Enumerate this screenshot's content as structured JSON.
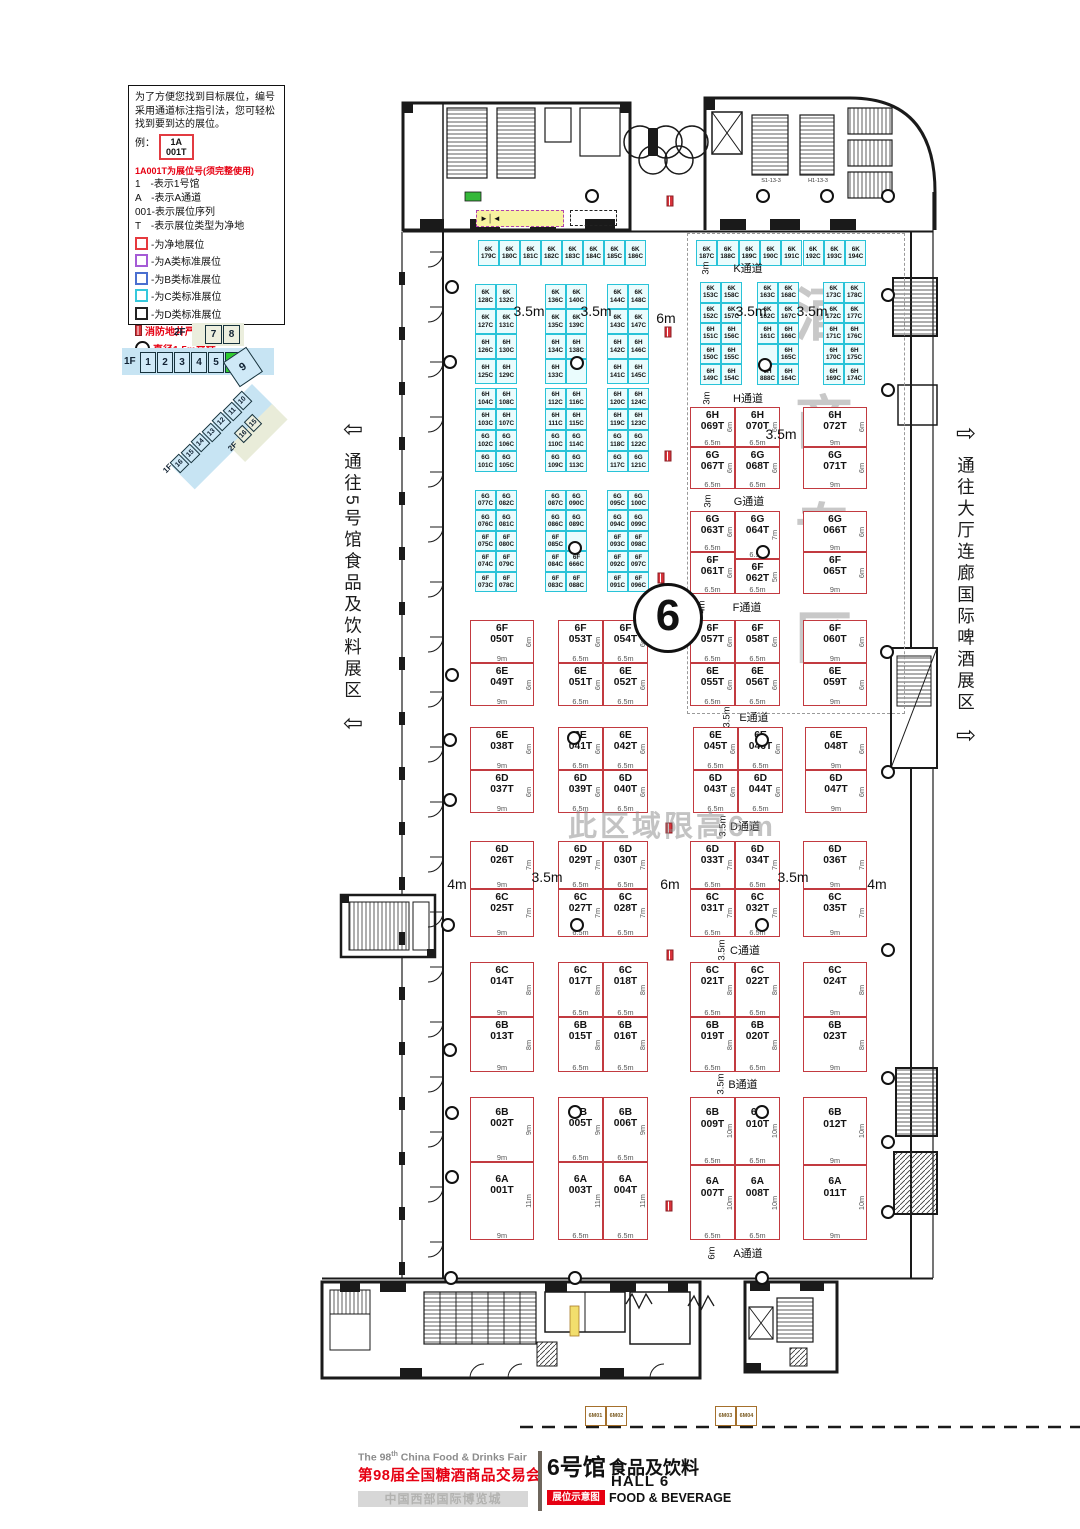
{
  "hall_circle": "6",
  "legend": {
    "intro": "为了方便您找到目标展位，编号采用通道标注指引法，您可轻松找到要到达的展位。",
    "example_label": "例：",
    "example_line1": "1A",
    "example_line2": "001T",
    "red_note": "1A001T为展位号(须完整使用)",
    "items": [
      "1　-表示1号馆",
      "A　-表示A通道",
      "001-表示展位序列",
      "T　-表示展位类型为净地"
    ],
    "swatches": [
      {
        "color": "#e6393e",
        "label": "-为净地展位"
      },
      {
        "color": "#a55bd6",
        "label": "-为A类标准展位"
      },
      {
        "color": "#4a6fd0",
        "label": "-为B类标准展位"
      },
      {
        "color": "#35c8dc",
        "label": "-为C类标准展位"
      },
      {
        "color": "#222222",
        "label": "-为D类标准展位"
      }
    ],
    "fire_note": "消防地井严禁遮挡",
    "pillar_note": "直径1.5m立柱"
  },
  "nav": {
    "f2_label": "2F",
    "f2_boxes": [
      "7",
      "8"
    ],
    "f1_label": "1F",
    "f1_boxes": [
      "1",
      "2",
      "3",
      "4",
      "5",
      "6"
    ],
    "active": "6",
    "big": "9",
    "diag_boxes": [
      "10",
      "11",
      "12",
      "13",
      "14",
      "15",
      "16"
    ],
    "diag_tail": "1F",
    "diag2_label": "2F",
    "diag2_boxes": [
      "15",
      "16"
    ]
  },
  "left_corridor": {
    "arrow": "⇦",
    "text": "通往5号馆食品及饮料展区"
  },
  "right_corridor": {
    "arrow": "⇨",
    "text": "通往大厅连廊国际啤酒展区"
  },
  "watermarks": {
    "zone_vertical": {
      "text": "酒商专区",
      "x": 824,
      "y_start": 310,
      "step": 108,
      "size": 58
    },
    "height_note": {
      "text": "此区域限高6m"
    }
  },
  "cyan_groups": [
    {
      "x": 478,
      "y": 240,
      "cw": 21,
      "rh": 26,
      "rows": [
        [
          "6K 179C",
          "6K 180C",
          "6K 181C",
          "6K 182C",
          "6K 183C",
          "6K 184C",
          "6K 185C",
          "6K 186C"
        ]
      ]
    },
    {
      "x": 696,
      "y": 240,
      "cw": 21.3,
      "rh": 26,
      "rows": [
        [
          "6K 187C",
          "6K 188C",
          "6K 189C",
          "6K 190C",
          "6K 191C",
          "6K 192C",
          "6K 193C",
          "6K 194C"
        ]
      ]
    },
    {
      "x": 475,
      "y": 284,
      "cw": 21,
      "rh": 25,
      "rows": [
        [
          "6K 128C",
          "6K 132C"
        ],
        [
          "6K 127C",
          "6K 131C"
        ],
        [
          "6H 126C",
          "6H 130C"
        ],
        [
          "6H 125C",
          "6H 129C"
        ]
      ]
    },
    {
      "x": 545,
      "y": 284,
      "cw": 21,
      "rh": 25,
      "rows": [
        [
          "6K 136C",
          "6K 140C"
        ],
        [
          "6K 135C",
          "6K 139C"
        ],
        [
          "6H 134C",
          "6H 138C"
        ],
        [
          "6H 133C",
          null
        ]
      ]
    },
    {
      "x": 607,
      "y": 284,
      "cw": 21,
      "rh": 25,
      "rows": [
        [
          "6K 144C",
          "6K 148C"
        ],
        [
          "6K 143C",
          "6K 147C"
        ],
        [
          "6H 142C",
          "6H 146C"
        ],
        [
          "6H 141C",
          "6H 145C"
        ]
      ]
    },
    {
      "x": 700,
      "y": 282,
      "cw": 21,
      "rh": 20.6,
      "rows": [
        [
          "6K 153C",
          "6K 158C"
        ],
        [
          "6K 152C",
          "6K 157C"
        ],
        [
          "6H 151C",
          "6H 156C"
        ],
        [
          "6H 150C",
          "6H 155C"
        ],
        [
          "6H 149C",
          "6H 154C"
        ]
      ]
    },
    {
      "x": 757,
      "y": 282,
      "cw": 21,
      "rh": 20.6,
      "rows": [
        [
          "6K 163C",
          "6K 168C"
        ],
        [
          "6K 162C",
          "6K 167C"
        ],
        [
          "6H 161C",
          "6H 166C"
        ],
        [
          null,
          "6H 165C"
        ],
        [
          "6H 888C",
          "6H 164C"
        ]
      ]
    },
    {
      "x": 823,
      "y": 282,
      "cw": 21,
      "rh": 20.6,
      "rows": [
        [
          "6K 173C",
          "6K 178C"
        ],
        [
          "6K 172C",
          "6K 177C"
        ],
        [
          "6H 171C",
          "6H 176C"
        ],
        [
          "6H 170C",
          "6H 175C"
        ],
        [
          "6H 169C",
          "6H 174C"
        ]
      ]
    },
    {
      "x": 475,
      "y": 388,
      "cw": 21,
      "rh": 21,
      "rows": [
        [
          "6H 104C",
          "6H 108C"
        ],
        [
          "6H 103C",
          "6H 107C"
        ],
        [
          "6G 102C",
          "6G 106C"
        ],
        [
          "6G 101C",
          "6G 105C"
        ]
      ]
    },
    {
      "x": 545,
      "y": 388,
      "cw": 21,
      "rh": 21,
      "rows": [
        [
          "6H 112C",
          "6H 116C"
        ],
        [
          "6H 111C",
          "6H 115C"
        ],
        [
          "6G 110C",
          "6G 114C"
        ],
        [
          "6G 109C",
          "6G 113C"
        ]
      ]
    },
    {
      "x": 607,
      "y": 388,
      "cw": 21,
      "rh": 21,
      "rows": [
        [
          "6H 120C",
          "6H 124C"
        ],
        [
          "6H 119C",
          "6H 123C"
        ],
        [
          "6G 118C",
          "6G 122C"
        ],
        [
          "6G 117C",
          "6G 121C"
        ]
      ]
    },
    {
      "x": 475,
      "y": 490,
      "cw": 21,
      "rh": 20.4,
      "rows": [
        [
          "6G 077C",
          "6G 082C"
        ],
        [
          "6G 076C",
          "6G 081C"
        ],
        [
          "6F 075C",
          "6F 080C"
        ],
        [
          "6F 074C",
          "6F 079C"
        ],
        [
          "6F 073C",
          "6F 078C"
        ]
      ]
    },
    {
      "x": 545,
      "y": 490,
      "cw": 21,
      "rh": 20.4,
      "rows": [
        [
          "6G 087C",
          "6G 090C"
        ],
        [
          "6G 086C",
          "6G 089C"
        ],
        [
          "6F 085C",
          null
        ],
        [
          "6F 084C",
          "6F 666C"
        ],
        [
          "6F 083C",
          "6F 088C"
        ]
      ]
    },
    {
      "x": 607,
      "y": 490,
      "cw": 21,
      "rh": 20.4,
      "rows": [
        [
          "6G 095C",
          "6G 100C"
        ],
        [
          "6G 094C",
          "6G 099C"
        ],
        [
          "6F 093C",
          "6F 098C"
        ],
        [
          "6F 092C",
          "6F 097C"
        ],
        [
          "6F 091C",
          "6F 096C"
        ]
      ]
    }
  ],
  "red_booths": [
    [
      "6H",
      "069T",
      690,
      407,
      45,
      40,
      "6.5m",
      "6m"
    ],
    [
      "6H",
      "070T",
      735,
      407,
      45,
      40,
      "6.5m",
      "6m"
    ],
    [
      "6H",
      "072T",
      803,
      407,
      64,
      40,
      "9m",
      "6m"
    ],
    [
      "6G",
      "067T",
      690,
      447,
      45,
      42,
      "6.5m",
      "6m"
    ],
    [
      "6G",
      "068T",
      735,
      447,
      45,
      42,
      "6.5m",
      "6m"
    ],
    [
      "6G",
      "071T",
      803,
      447,
      64,
      42,
      "9m",
      "6m"
    ],
    [
      "6G",
      "063T",
      690,
      511,
      45,
      41,
      "6.5m",
      "6m"
    ],
    [
      "6G",
      "064T",
      735,
      511,
      45,
      48,
      "6.5m",
      "7m"
    ],
    [
      "6G",
      "066T",
      803,
      511,
      64,
      41,
      "9m",
      "6m"
    ],
    [
      "6F",
      "061T",
      690,
      552,
      45,
      42,
      "6.5m",
      "6m"
    ],
    [
      "6F",
      "062T",
      735,
      559,
      45,
      35,
      "6.5m",
      "5m"
    ],
    [
      "6F",
      "065T",
      803,
      552,
      64,
      42,
      "9m",
      "6m"
    ],
    [
      "6F",
      "057T",
      690,
      620,
      45,
      43,
      "6.5m",
      "6m"
    ],
    [
      "6F",
      "058T",
      735,
      620,
      45,
      43,
      "6.5m",
      "6m"
    ],
    [
      "6F",
      "060T",
      803,
      620,
      64,
      43,
      "9m",
      "6m"
    ],
    [
      "6E",
      "055T",
      690,
      663,
      45,
      43,
      "6.5m",
      "6m"
    ],
    [
      "6E",
      "056T",
      735,
      663,
      45,
      43,
      "6.5m",
      "6m"
    ],
    [
      "6E",
      "059T",
      803,
      663,
      64,
      43,
      "9m",
      "6m"
    ],
    [
      "6F",
      "050T",
      470,
      620,
      64,
      43,
      "9m",
      "6m"
    ],
    [
      "6E",
      "049T",
      470,
      663,
      64,
      43,
      "9m",
      "6m"
    ],
    [
      "6F",
      "053T",
      558,
      620,
      45,
      43,
      "6.5m",
      "6m"
    ],
    [
      "6F",
      "054T",
      603,
      620,
      45,
      43,
      "6.5m",
      "6m"
    ],
    [
      "6E",
      "051T",
      558,
      663,
      45,
      43,
      "6.5m",
      "6m"
    ],
    [
      "6E",
      "052T",
      603,
      663,
      45,
      43,
      "6.5m",
      "6m"
    ],
    [
      "6E",
      "038T",
      470,
      727,
      64,
      43,
      "9m",
      "6m"
    ],
    [
      "6D",
      "037T",
      470,
      770,
      64,
      43,
      "9m",
      "6m"
    ],
    [
      "6E",
      "041T",
      558,
      727,
      45,
      43,
      "6.5m",
      "6m"
    ],
    [
      "6E",
      "042T",
      603,
      727,
      45,
      43,
      "6.5m",
      "6m"
    ],
    [
      "6D",
      "039T",
      558,
      770,
      45,
      43,
      "6.5m",
      "6m"
    ],
    [
      "6D",
      "040T",
      603,
      770,
      45,
      43,
      "6.5m",
      "6m"
    ],
    [
      "6E",
      "045T",
      693,
      727,
      45,
      43,
      "6.5m",
      "6m"
    ],
    [
      "6E",
      "046T",
      738,
      727,
      45,
      43,
      "6.5m",
      "6m"
    ],
    [
      "6D",
      "043T",
      693,
      770,
      45,
      43,
      "6.5m",
      "6m"
    ],
    [
      "6D",
      "044T",
      738,
      770,
      45,
      43,
      "6.5m",
      "6m"
    ],
    [
      "6E",
      "048T",
      805,
      727,
      62,
      43,
      "9m",
      "6m"
    ],
    [
      "6D",
      "047T",
      805,
      770,
      62,
      43,
      "9m",
      "6m"
    ],
    [
      "6D",
      "026T",
      470,
      841,
      64,
      48,
      "9m",
      "7m"
    ],
    [
      "6C",
      "025T",
      470,
      889,
      64,
      48,
      "9m",
      "7m"
    ],
    [
      "6D",
      "029T",
      558,
      841,
      45,
      48,
      "6.5m",
      "7m"
    ],
    [
      "6D",
      "030T",
      603,
      841,
      45,
      48,
      "6.5m",
      "7m"
    ],
    [
      "6C",
      "027T",
      558,
      889,
      45,
      48,
      "6.5m",
      "7m"
    ],
    [
      "6C",
      "028T",
      603,
      889,
      45,
      48,
      "6.5m",
      "7m"
    ],
    [
      "6D",
      "033T",
      690,
      841,
      45,
      48,
      "6.5m",
      "7m"
    ],
    [
      "6D",
      "034T",
      735,
      841,
      45,
      48,
      "6.5m",
      "7m"
    ],
    [
      "6C",
      "031T",
      690,
      889,
      45,
      48,
      "6.5m",
      "7m"
    ],
    [
      "6C",
      "032T",
      735,
      889,
      45,
      48,
      "6.5m",
      "7m"
    ],
    [
      "6D",
      "036T",
      803,
      841,
      64,
      48,
      "9m",
      "7m"
    ],
    [
      "6C",
      "035T",
      803,
      889,
      64,
      48,
      "9m",
      "7m"
    ],
    [
      "6C",
      "014T",
      470,
      962,
      64,
      55,
      "9m",
      "8m"
    ],
    [
      "6B",
      "013T",
      470,
      1017,
      64,
      55,
      "9m",
      "8m"
    ],
    [
      "6C",
      "017T",
      558,
      962,
      45,
      55,
      "6.5m",
      "8m"
    ],
    [
      "6C",
      "018T",
      603,
      962,
      45,
      55,
      "6.5m",
      "8m"
    ],
    [
      "6B",
      "015T",
      558,
      1017,
      45,
      55,
      "6.5m",
      "8m"
    ],
    [
      "6B",
      "016T",
      603,
      1017,
      45,
      55,
      "6.5m",
      "8m"
    ],
    [
      "6C",
      "021T",
      690,
      962,
      45,
      55,
      "6.5m",
      "8m"
    ],
    [
      "6C",
      "022T",
      735,
      962,
      45,
      55,
      "6.5m",
      "8m"
    ],
    [
      "6B",
      "019T",
      690,
      1017,
      45,
      55,
      "6.5m",
      "8m"
    ],
    [
      "6B",
      "020T",
      735,
      1017,
      45,
      55,
      "6.5m",
      "8m"
    ],
    [
      "6C",
      "024T",
      803,
      962,
      64,
      55,
      "9m",
      "8m"
    ],
    [
      "6B",
      "023T",
      803,
      1017,
      64,
      55,
      "9m",
      "8m"
    ],
    [
      "6B",
      "002T",
      470,
      1097,
      64,
      65,
      "9m",
      "9m"
    ],
    [
      "6A",
      "001T",
      470,
      1162,
      64,
      78,
      "9m",
      "11m"
    ],
    [
      "6B",
      "005T",
      558,
      1097,
      45,
      65,
      "6.5m",
      "9m"
    ],
    [
      "6B",
      "006T",
      603,
      1097,
      45,
      65,
      "6.5m",
      "9m"
    ],
    [
      "6A",
      "003T",
      558,
      1162,
      45,
      78,
      "6.5m",
      "11m"
    ],
    [
      "6A",
      "004T",
      603,
      1162,
      45,
      78,
      "6.5m",
      "11m"
    ],
    [
      "6B",
      "009T",
      690,
      1097,
      45,
      68,
      "6.5m",
      "10m"
    ],
    [
      "6B",
      "010T",
      735,
      1097,
      45,
      68,
      "6.5m",
      "10m"
    ],
    [
      "6A",
      "007T",
      690,
      1165,
      45,
      75,
      "6.5m",
      "10m"
    ],
    [
      "6A",
      "008T",
      735,
      1165,
      45,
      75,
      "6.5m",
      "10m"
    ],
    [
      "6B",
      "012T",
      803,
      1097,
      64,
      68,
      "9m",
      "10m"
    ],
    [
      "6A",
      "011T",
      803,
      1165,
      64,
      75,
      "9m",
      "10m"
    ]
  ],
  "aisles": [
    [
      "K通道",
      748,
      268,
      "3m",
      706
    ],
    [
      "H通道",
      748,
      398,
      "3m",
      707
    ],
    [
      "G通道",
      749,
      501,
      "3m",
      708
    ],
    [
      "F通道",
      747,
      607,
      "4m",
      702
    ],
    [
      "E通道",
      754,
      717,
      "3.5m",
      727
    ],
    [
      "D通道",
      745,
      826,
      "3.5m",
      723
    ],
    [
      "C通道",
      745,
      950,
      "3.5m",
      722
    ],
    [
      "B通道",
      743,
      1084,
      "3.5m",
      721
    ],
    [
      "A通道",
      748,
      1253,
      "6m",
      712
    ]
  ],
  "dim_labels": [
    [
      "3.5m",
      529,
      311
    ],
    [
      "3.5m",
      596,
      311
    ],
    [
      "6m",
      666,
      318
    ],
    [
      "3.5m",
      751,
      311
    ],
    [
      "3.5m",
      812,
      311
    ],
    [
      "3.5m",
      781,
      434
    ],
    [
      "4m",
      457,
      884
    ],
    [
      "3.5m",
      547,
      877
    ],
    [
      "6m",
      670,
      884
    ],
    [
      "3.5m",
      793,
      877
    ],
    [
      "4m",
      877,
      884
    ]
  ],
  "pillars": [
    [
      577,
      363
    ],
    [
      765,
      365
    ],
    [
      575,
      548
    ],
    [
      763,
      552
    ],
    [
      574,
      738
    ],
    [
      762,
      740
    ],
    [
      577,
      925
    ],
    [
      762,
      925
    ],
    [
      575,
      1112
    ],
    [
      762,
      1112
    ],
    [
      452,
      287
    ],
    [
      450,
      362
    ],
    [
      452,
      675
    ],
    [
      450,
      740
    ],
    [
      450,
      800
    ],
    [
      448,
      925
    ],
    [
      450,
      1050
    ],
    [
      452,
      1113
    ],
    [
      452,
      1177
    ],
    [
      592,
      196
    ],
    [
      763,
      196
    ],
    [
      827,
      196
    ],
    [
      888,
      196
    ],
    [
      451,
      1278
    ],
    [
      575,
      1278
    ],
    [
      762,
      1278
    ],
    [
      888,
      295
    ],
    [
      888,
      390
    ],
    [
      887,
      652
    ],
    [
      888,
      772
    ],
    [
      888,
      950
    ],
    [
      888,
      1078
    ],
    [
      888,
      1142
    ],
    [
      888,
      1212
    ]
  ],
  "hydrants": [
    [
      670,
      201
    ],
    [
      668,
      332
    ],
    [
      668,
      456
    ],
    [
      661,
      578
    ],
    [
      669,
      828
    ],
    [
      670,
      955
    ],
    [
      669,
      1206
    ]
  ],
  "stair_labels": [
    [
      "S1-13-3",
      771,
      181
    ],
    [
      "H1-13-3",
      818,
      181
    ]
  ],
  "service_boxes": {
    "y": 1406,
    "items": [
      [
        "6M01",
        585
      ],
      [
        "6M02",
        606
      ],
      [
        "6M03",
        715
      ],
      [
        "6M04",
        736
      ]
    ]
  },
  "footer": {
    "en_pre": "The 98",
    "en_sup": "th",
    "en_post": " China Food & Drinks Fair",
    "cn_title": "第98届全国糖酒商品交易会",
    "venue": "中国西部国际博览城",
    "hall_cn": "6号馆",
    "cat_cn": "食品及饮料",
    "hall_en": "HALL 6",
    "badge": "展位示意图",
    "cat_en": "FOOD & BEVERAGE"
  },
  "colors": {
    "cyan_booth": "#29c3d8",
    "red_booth": "#c23a40",
    "brand_red": "#e60012",
    "active_green": "#2ecc2e",
    "service_tan": "#a5702c"
  }
}
